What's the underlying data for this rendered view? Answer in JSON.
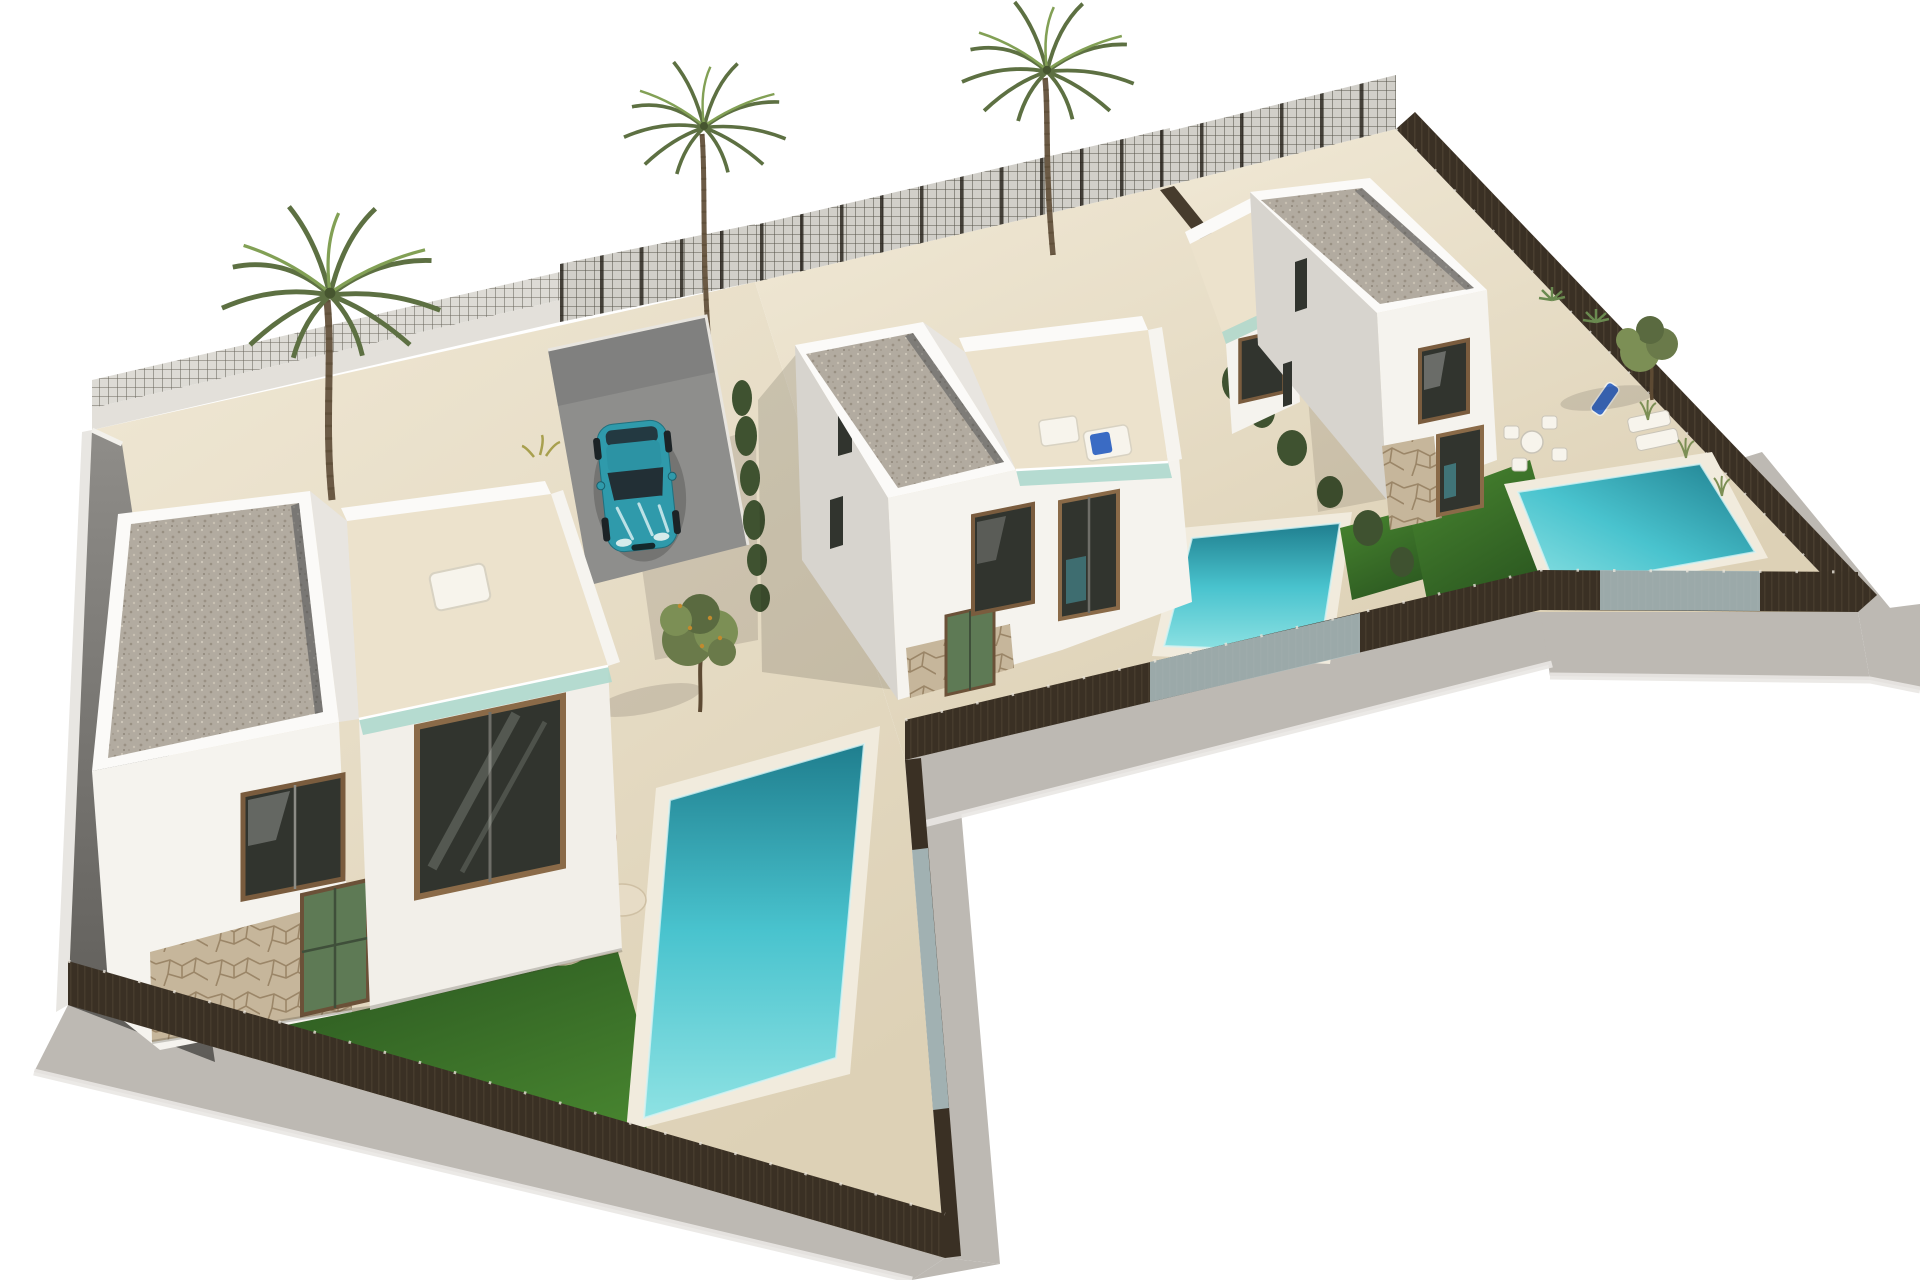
{
  "scene": {
    "description": "Aerial 3D architectural rendering of three modern two-storey white villas, each on a fenced plot with a private pool, lawn and terrace, on a plain white background",
    "villa_count": 3,
    "palm_tree_count": 3,
    "pool_count": 3
  },
  "colors": {
    "background": "#ffffff",
    "ground_light": "#f0e8d5",
    "ground": "#ddd1b6",
    "apron": "#bdb9b3",
    "apron_edge": "#e9e7e3",
    "wall_white": "#f5f3ee",
    "wall_soft": "#eceae4",
    "wall_shaded": "#d7d4ce",
    "wall_dark": "#8f8d89",
    "wall_darker": "#5e5c58",
    "parapet": "#fbfaf8",
    "roof_gravel": "#b2aba0",
    "stone": "#c6b69b",
    "stone_line": "#9b8668",
    "lawn": "#47842f",
    "lawn_dark": "#27511e",
    "pool_water": "#49c3ce",
    "pool_deep": "#1f7e8e",
    "pool_shallow": "#8ee2e3",
    "pool_coping": "#f1ebdd",
    "glass_balustrade": "#aed8cd",
    "glass_fence": "#b4c8cb",
    "fence_dark": "#3a3024",
    "fence_mesh_light": "#d8d6d0",
    "hedge": "#3f5230",
    "tree_olive": "#6a7a4a",
    "tree_olive_light": "#7c8f55",
    "palm_green": "#5d7042",
    "palm_green_light": "#82a055",
    "trunk_brown": "#6b5a45",
    "car_body": "#2f9aab",
    "car_glass": "#222f35",
    "furniture_tan": "#c7a98b",
    "furniture_cream": "#e7dcc6",
    "lounger_blue": "#3a6bc4",
    "window_glass": "#31342e",
    "window_frame": "#7a5c3e",
    "driveway": "#8e8e8c",
    "shadow": "#1d1a14"
  },
  "objects": {
    "villas": [
      {
        "id": "villa-1",
        "position": "left-foreground",
        "floors": 2,
        "roof": "flat gravel",
        "features": [
          "roof terrace",
          "glass balustrade",
          "stone clad ground floor",
          "pool",
          "lawn",
          "patio lounge set"
        ]
      },
      {
        "id": "villa-2",
        "position": "middle",
        "floors": 2,
        "roof": "flat gravel",
        "features": [
          "roof terrace with sun lounger",
          "glass balustrade",
          "pool",
          "driveway with parked car"
        ]
      },
      {
        "id": "villa-3",
        "position": "right-background",
        "floors": 2,
        "roof": "flat gravel",
        "features": [
          "roof terrace wing",
          "stone clad ground floor",
          "pool",
          "lawn",
          "outdoor dining set",
          "sun loungers"
        ]
      }
    ],
    "car": {
      "type": "hatchback",
      "color_name": "teal"
    },
    "fences": "dark privacy mesh panels with glass sections beside pools",
    "vegetation": [
      "3 palm trees",
      "2 small olive trees",
      "hedges and shrubs along boundaries"
    ]
  }
}
